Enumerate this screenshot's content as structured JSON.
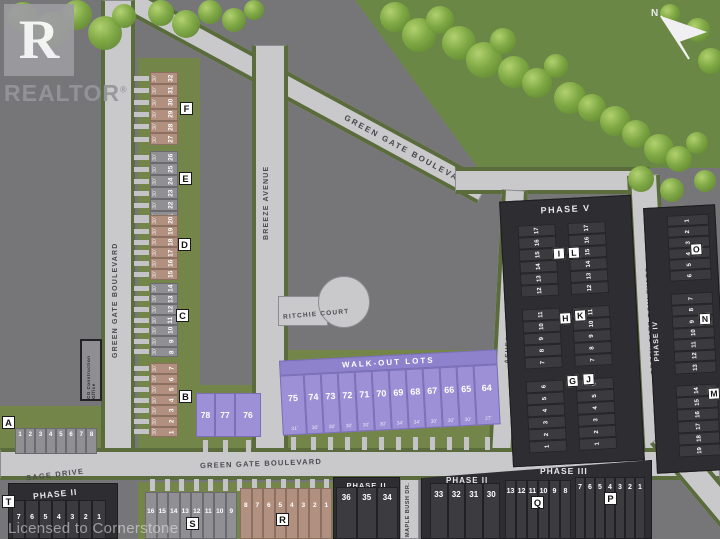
{
  "map": {
    "north_label": "N",
    "logo": {
      "letter": "R",
      "word": "REALTOR",
      "reg": "®"
    },
    "license_text": "Licensed to Cornerstone",
    "construction_office": "CO Construction Office",
    "walkout_banner": "WALK-OUT LOTS",
    "streets": {
      "green_gate_left": "GREEN GATE BOULEVARD",
      "green_gate_top": "GREEN GATE BOULEVARD",
      "green_gate_right": "GREEN GATE BOULEVARD",
      "green_gate_bottom": "GREEN GATE BOULEVARD",
      "breeze": "BREEZE AVENUE",
      "ritchie": "RITCHIE COURT",
      "sage": "SAGE DRIVE",
      "ashford": "ASHFORD STREET",
      "maple_bush": "MAPLE BUSH DR."
    },
    "phase_labels": {
      "phase2_t": "PHASE II",
      "phase2_mid": "PHASE II",
      "phase2_right": "PHASE II",
      "phase3": "PHASE III",
      "phase4": "PHASE IV",
      "phase5": "PHASE V"
    }
  },
  "blocks": {
    "F": {
      "badge": "F",
      "style": "tan",
      "lots": [
        "32",
        "31",
        "30",
        "29",
        "28",
        "27"
      ]
    },
    "E": {
      "badge": "E",
      "style": "gray",
      "lots": [
        "26",
        "25",
        "24",
        "23",
        "22",
        "21"
      ]
    },
    "D": {
      "badge": "D",
      "style": "tan",
      "lots": [
        "20",
        "19",
        "18",
        "17",
        "16",
        "15"
      ]
    },
    "C": {
      "badge": "C",
      "style": "gray",
      "lots": [
        "14",
        "13",
        "12",
        "11",
        "10",
        "9",
        "8"
      ]
    },
    "B": {
      "badge": "B",
      "style": "tan",
      "lots": [
        "7",
        "6",
        "5",
        "4",
        "3",
        "2",
        "1"
      ]
    },
    "A": {
      "badge": "A",
      "style": "gray",
      "lots": [
        "1",
        "2",
        "3",
        "4",
        "5",
        "6",
        "7",
        "8"
      ]
    },
    "T": {
      "badge": "T",
      "style": "dark",
      "lots": [
        "7",
        "6",
        "5",
        "4",
        "3",
        "2",
        "1"
      ]
    },
    "S": {
      "badge": "S",
      "style": "gray",
      "lots": [
        "16",
        "15",
        "14",
        "13",
        "12",
        "11",
        "10",
        "9"
      ]
    },
    "R": {
      "badge": "R",
      "style": "tan",
      "lots": [
        "8",
        "7",
        "6",
        "5",
        "4",
        "3",
        "2",
        "1"
      ]
    },
    "Q": {
      "badge": "Q",
      "style": "dark",
      "lots": [
        "13",
        "12",
        "11",
        "10",
        "9",
        "8"
      ]
    },
    "P": {
      "badge": "P",
      "style": "dark",
      "lots": [
        "7",
        "6",
        "5",
        "4",
        "3",
        "2",
        "1"
      ]
    },
    "I": {
      "badge": "I",
      "style": "dark",
      "lots": [
        "17",
        "16",
        "15",
        "14",
        "13",
        "12"
      ]
    },
    "L": {
      "badge": "L",
      "style": "dark",
      "lots": [
        "17",
        "16",
        "15",
        "14",
        "13",
        "12"
      ]
    },
    "H": {
      "badge": "H",
      "style": "dark",
      "lots": [
        "11",
        "10",
        "9",
        "8",
        "7"
      ]
    },
    "K": {
      "badge": "K",
      "style": "dark",
      "lots": [
        "11",
        "10",
        "9",
        "8",
        "7"
      ]
    },
    "G": {
      "badge": "G",
      "style": "dark",
      "lots": [
        "6",
        "5",
        "4",
        "3",
        "2",
        "1"
      ]
    },
    "J": {
      "badge": "J",
      "style": "dark",
      "lots": [
        "6",
        "5",
        "4",
        "3",
        "2",
        "1"
      ]
    },
    "O": {
      "badge": "O",
      "style": "dark",
      "lots": [
        "1",
        "2",
        "3",
        "4",
        "5",
        "6"
      ]
    },
    "N": {
      "badge": "N",
      "style": "dark",
      "lots": [
        "7",
        "8",
        "9",
        "10",
        "11",
        "12",
        "13"
      ]
    },
    "M": {
      "badge": "M",
      "style": "dark",
      "lots": [
        "14",
        "15",
        "16",
        "17",
        "18",
        "19"
      ]
    }
  },
  "standalone_lots": {
    "purple_trio": [
      "78",
      "77",
      "76"
    ],
    "walkout": {
      "numbers": [
        "75",
        "74",
        "73",
        "72",
        "71",
        "70",
        "69",
        "68",
        "67",
        "66",
        "65",
        "64"
      ],
      "widths": [
        "31'",
        "30'",
        "30'",
        "30'",
        "30'",
        "30'",
        "34'",
        "34'",
        "30'",
        "30'",
        "30'",
        "27'"
      ]
    },
    "phase2_mid_lots": [
      "36",
      "35",
      "34"
    ],
    "phase2_right_lots": [
      "33",
      "32",
      "31",
      "30"
    ]
  },
  "lot_meta": {
    "west_width_label": "30'"
  },
  "colors": {
    "background": "#767679",
    "road": "#c9c9cc",
    "grass_strip": "#5a6c3c",
    "lawn": "#74854a",
    "nature_green": "#6b8746",
    "lot_tan": "#b29080",
    "lot_gray": "#909094",
    "lot_purple": "#9d90d6",
    "lot_dark": "#3c3c40",
    "dark_block": "#2e2e32",
    "walkout_banner_purple": "#8e82cc"
  }
}
